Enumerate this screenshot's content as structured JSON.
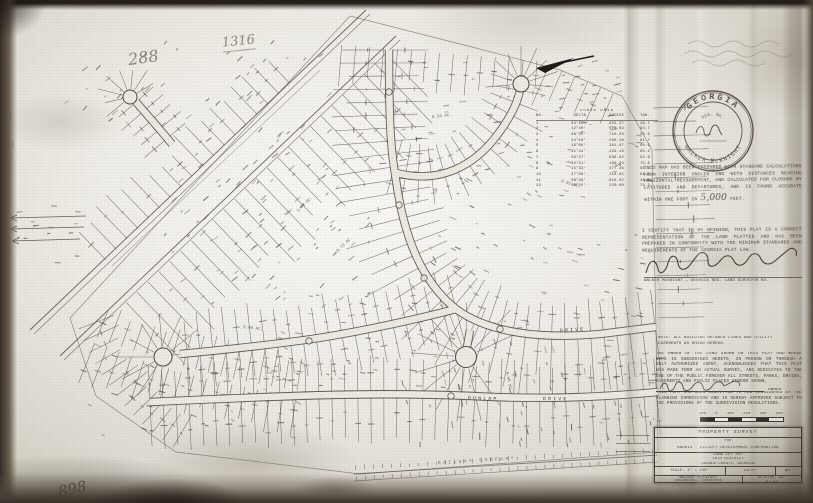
{
  "handwriting": {
    "top_left_a": "288",
    "top_left_b": "1316",
    "bottom_left": "898"
  },
  "seal": {
    "arc_top": "GEORGIA",
    "arc_bottom": "WALKER McKNIGHT",
    "inner_top": "REG. No."
  },
  "statements": {
    "accuracy_1": "THIS MAP HAS BEEN PREPARED WITH STANDARD CALCULATIONS FROM INTERIOR ANGLES AND WITH DISTANCES BEARING HORIZONTAL MEASUREMENT, AND CALCULATED FOR CLOSURE BY LATITUDES AND DEPARTURES, AND IS FOUND ACCURATE WITHIN ONE FOOT IN",
    "accuracy_ratio": "5,000",
    "accuracy_2": "FEET.",
    "certification": "I CERTIFY THAT IN MY OPINION, THIS PLAT IS A CORRECT REPRESENTATION OF THE LAND PLATTED AND HAS BEEN PREPARED IN CONFORMITY WITH THE MINIMUM STANDARDS AND REQUIREMENTS OF THE GEORGIA PLAT LAW.",
    "cert_caption": "WALKER McKNIGHT — GEORGIA REG. LAND SURVEYOR No.",
    "note": "NOTE: ALL BUILDING SETBACK LINES AND UTILITY EASEMENTS AS SHOWN HEREON.",
    "owner_dedication": "THE OWNER OF THE LAND SHOWN ON THIS PLAT AND WHOSE NAME IS SUBSCRIBED HERETO, IN PERSON OR THROUGH A DULY AUTHORIZED AGENT, ACKNOWLEDGES THAT THIS PLAT WAS MADE FROM AN ACTUAL SURVEY, AND DEDICATES TO THE USE OF THE PUBLIC FOREVER ALL STREETS, PARKS, DRAINS, EASEMENTS AND PUBLIC PLACES HEREON SHOWN.",
    "owner_label": "OWNER",
    "approval": "THIS PLAT HAS BEEN SUBMITTED TO AND CONSIDERED BY THE PLANNING COMMISSION AND IS HEREBY APPROVED SUBJECT TO THE PROVISIONS OF THE SUBDIVISION REGULATIONS."
  },
  "curve_table": {
    "title": "CURVE  DATA",
    "headers": [
      "NO.",
      "DELTA",
      "RADIUS",
      "TAN."
    ],
    "rows": [
      [
        "1",
        "03°12'",
        "955.37",
        "26.7"
      ],
      [
        "2",
        "12°40'",
        "573.69",
        "63.7"
      ],
      [
        "3",
        "08°55'",
        "716.20",
        "55.9"
      ],
      [
        "4",
        "24°18'",
        "286.48",
        "61.7"
      ],
      [
        "5",
        "18°06'",
        "381.97",
        "60.9"
      ],
      [
        "6",
        "31°44'",
        "229.18",
        "65.2"
      ],
      [
        "7",
        "09°27'",
        "636.62",
        "52.6"
      ],
      [
        "8",
        "42°51'",
        "190.99",
        "75.0"
      ],
      [
        "9",
        "15°33'",
        "477.46",
        "65.2"
      ],
      [
        "10",
        "27°08'",
        "254.65",
        "61.5"
      ],
      [
        "11",
        "06°49'",
        "819.02",
        "48.8"
      ],
      [
        "12",
        "36°25'",
        "220.00",
        "72.3"
      ]
    ]
  },
  "scale_bar": {
    "labels": [
      "100",
      "0",
      "100",
      "200",
      "300",
      "400"
    ]
  },
  "title_block": {
    "line1": "PROPERTY  SURVEY",
    "line2": "FOR",
    "line3": "HARRIS - ELLIOTT  DEVELOPMENT  CORPORATION",
    "loc1": "LAND LOT 297",
    "loc2": "18th DISTRICT",
    "loc3": "DeKALB COUNTY, GEORGIA",
    "scale": "SCALE: 1\" = 100'",
    "date": "DATE:",
    "no": "No.",
    "firm1": "WALKER  McKNIGHT",
    "firm2": "ENGINEERS — SURVEYORS",
    "firm_city": "DECATUR, GA.",
    "sheet": "57-52"
  },
  "map_labels": {
    "street_a1": "DUNLAP",
    "street_a2": "DRIVE",
    "street_b": "DRIVE",
    "railroad": "RAILWAY  COMPANY",
    "areas": [
      "1.03 AC.",
      "0.72 AC.",
      "0.54 AC.",
      "0.61 AC.",
      "0.66 AC.",
      "0.58 AC."
    ]
  }
}
